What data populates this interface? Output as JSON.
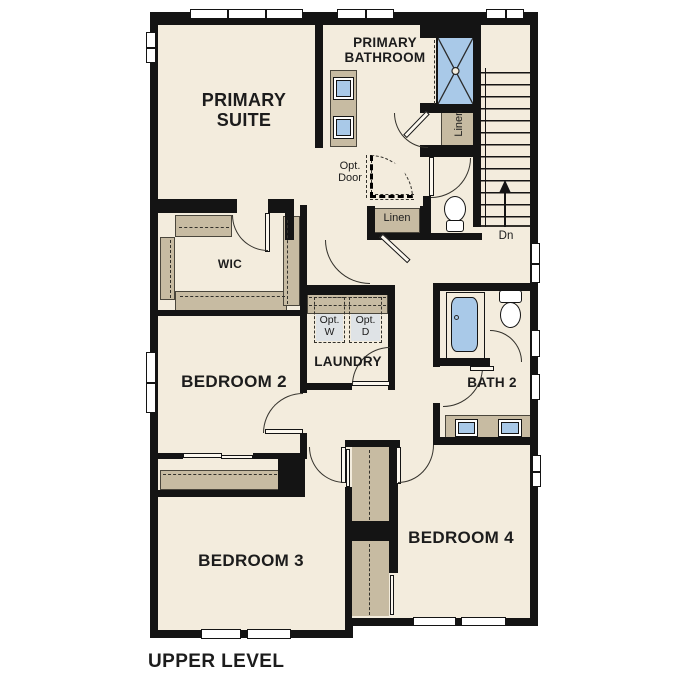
{
  "title": "UPPER LEVEL",
  "rooms": {
    "primary_suite": {
      "line1": "PRIMARY",
      "line2": "SUITE"
    },
    "primary_bathroom": {
      "line1": "PRIMARY",
      "line2": "BATHROOM"
    },
    "wic": {
      "label": "WIC"
    },
    "bedroom2": {
      "label": "BEDROOM 2"
    },
    "laundry": {
      "label": "LAUNDRY"
    },
    "bath2": {
      "label": "BATH 2"
    },
    "bedroom3": {
      "label": "BEDROOM 3"
    },
    "bedroom4": {
      "label": "BEDROOM 4"
    }
  },
  "annotations": {
    "opt_door": {
      "line1": "Opt.",
      "line2": "Door"
    },
    "linen_bath": {
      "label": "Linen"
    },
    "linen_hall": {
      "label": "Linen"
    },
    "stairs": {
      "down": "Dn"
    },
    "opt_washer": {
      "line1": "Opt.",
      "line2": "W"
    },
    "opt_dryer": {
      "line1": "Opt.",
      "line2": "D"
    }
  },
  "colors": {
    "background": "#ffffff",
    "floor": "#f3ecdd",
    "wall": "#141414",
    "cabinetry": "#c7bba2",
    "fixture_blue": "#a9c9e8",
    "appliance_fill": "#dfe3e6",
    "text": "#1c1c1c"
  }
}
